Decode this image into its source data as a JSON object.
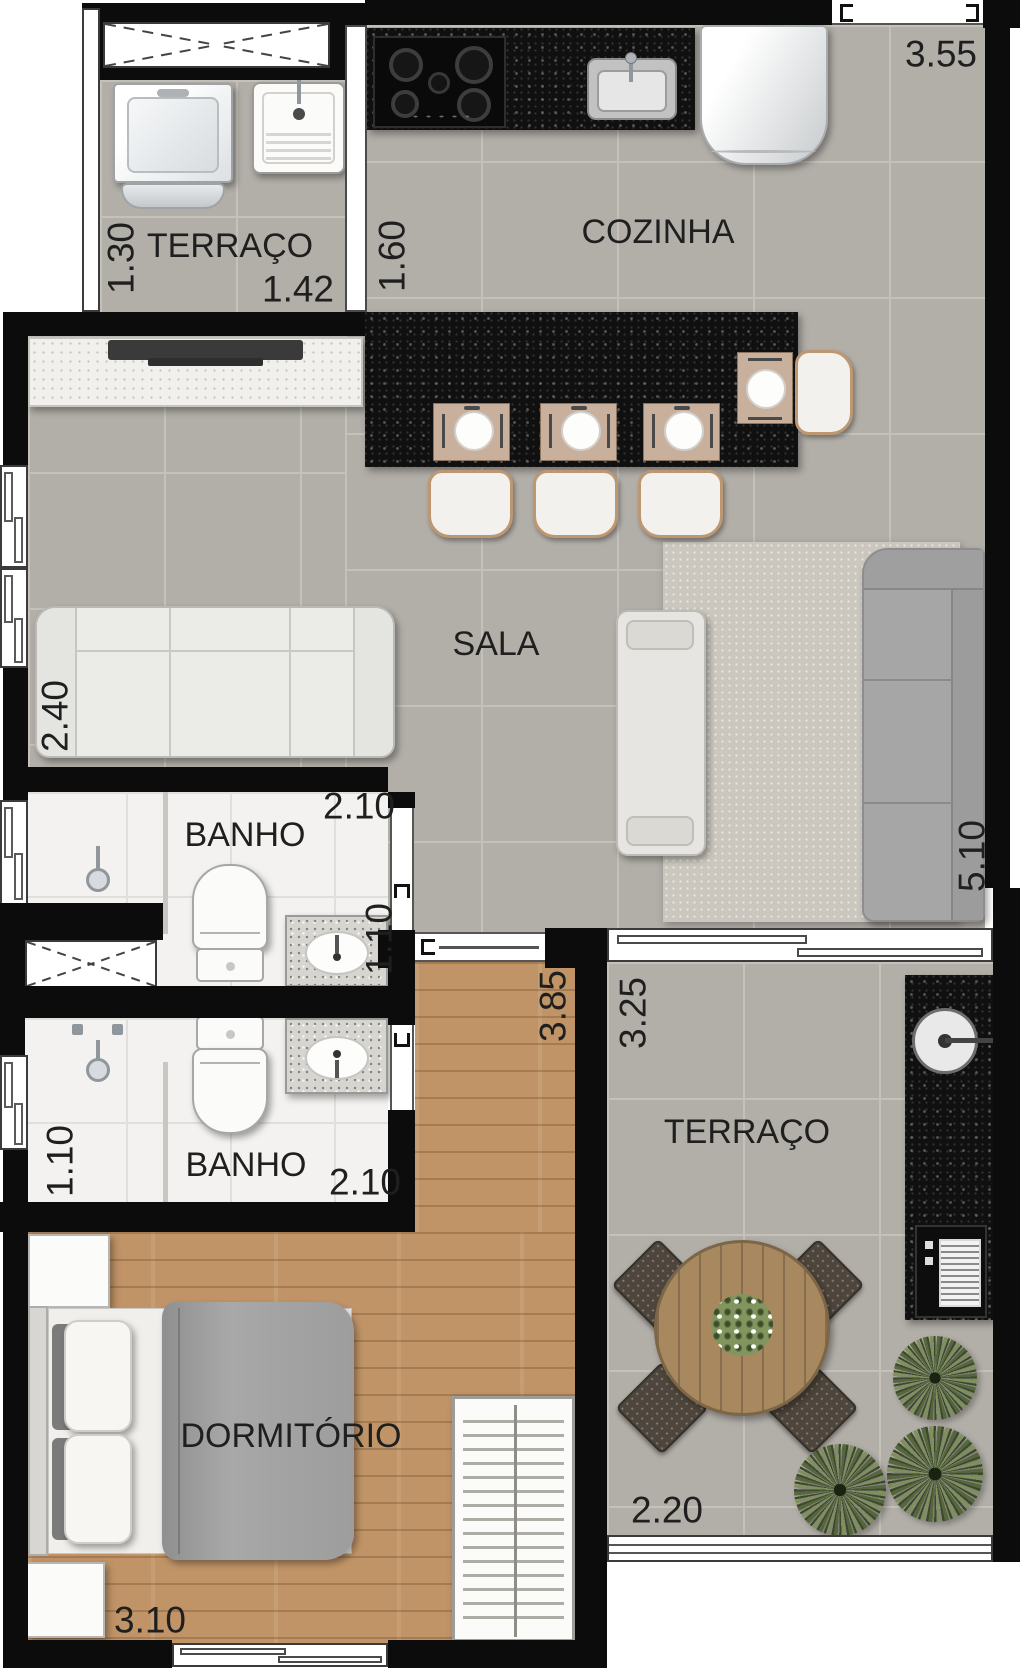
{
  "plan": {
    "type": "apartment-floor-plan",
    "colors": {
      "wall": "#0c0c0c",
      "ink": "#1f1f1f",
      "tile": "#b2aea8",
      "tile_line": "#c4c0ba",
      "bath": "#f3f2f0",
      "wood": "#c09467",
      "granite": "#101010"
    },
    "rooms": {
      "service_terrace": {
        "name": "TERRAÇO",
        "width": "1.42",
        "height": "1.30"
      },
      "kitchen": {
        "name": "COZINHA",
        "width": "3.55",
        "height": "1.60"
      },
      "living": {
        "name": "SALA",
        "left_height": "2.40",
        "right_height": "5.10"
      },
      "bath_top": {
        "name": "BANHO",
        "width": "2.10",
        "height": "1.10"
      },
      "bath_bottom": {
        "name": "BANHO",
        "width": "2.10",
        "height": "1.10"
      },
      "bedroom": {
        "name": "DORMITÓRIO",
        "width": "3.10",
        "height": "3.85"
      },
      "terrace": {
        "name": "TERRAÇO",
        "width": "2.20",
        "height": "3.25"
      }
    }
  }
}
